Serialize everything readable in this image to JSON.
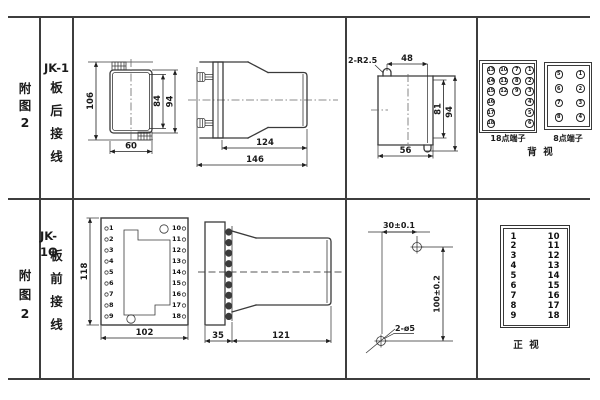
{
  "row1": {
    "fig": [
      "附",
      "图",
      "2"
    ],
    "model": "JK-1",
    "wiring": [
      "板",
      "后",
      "接",
      "线"
    ],
    "rear_view": {
      "height": "106",
      "inner_height": "84",
      "outer_height": "94",
      "width": "60"
    },
    "side_view": {
      "body_depth": "124",
      "total_depth": "146"
    },
    "cutout": {
      "radius_note": "2-R2.5",
      "top_width": "48",
      "inner_height": "81",
      "outer_height": "94",
      "bottom_width": "56"
    },
    "terminals18": {
      "label": "18点端子",
      "grid": [
        [
          "13",
          "10",
          "7",
          "1"
        ],
        [
          "14",
          "11",
          "8",
          "2"
        ],
        [
          "15",
          "12",
          "9",
          "3"
        ],
        [
          "16",
          "",
          "",
          "4"
        ],
        [
          "17",
          "",
          "",
          "5"
        ],
        [
          "18",
          "",
          "",
          "6"
        ]
      ]
    },
    "terminals8": {
      "label": "8点端子",
      "grid": [
        [
          "5",
          "1"
        ],
        [
          "6",
          "2"
        ],
        [
          "7",
          "3"
        ],
        [
          "8",
          "4"
        ]
      ]
    },
    "view_label": "背  视"
  },
  "row2": {
    "fig": [
      "附",
      "图",
      "2"
    ],
    "model": "JK-1Q",
    "wiring": [
      "板",
      "前",
      "接",
      "线"
    ],
    "front_view": {
      "height": "118",
      "width": "102",
      "left_terms": [
        "1",
        "2",
        "3",
        "4",
        "5",
        "6",
        "7",
        "8",
        "9"
      ],
      "right_terms": [
        "10",
        "11",
        "12",
        "13",
        "14",
        "15",
        "16",
        "17",
        "18"
      ]
    },
    "side_view": {
      "plate_depth": "35",
      "body_depth": "121"
    },
    "drill": {
      "horizontal": "30±0.1",
      "vertical": "100±0.2",
      "holes_note": "2-ø5"
    },
    "term_table": {
      "left": [
        "1",
        "2",
        "3",
        "4",
        "5",
        "6",
        "7",
        "8",
        "9"
      ],
      "right": [
        "10",
        "11",
        "12",
        "13",
        "14",
        "15",
        "16",
        "17",
        "18"
      ],
      "view_label": "正  视"
    }
  }
}
